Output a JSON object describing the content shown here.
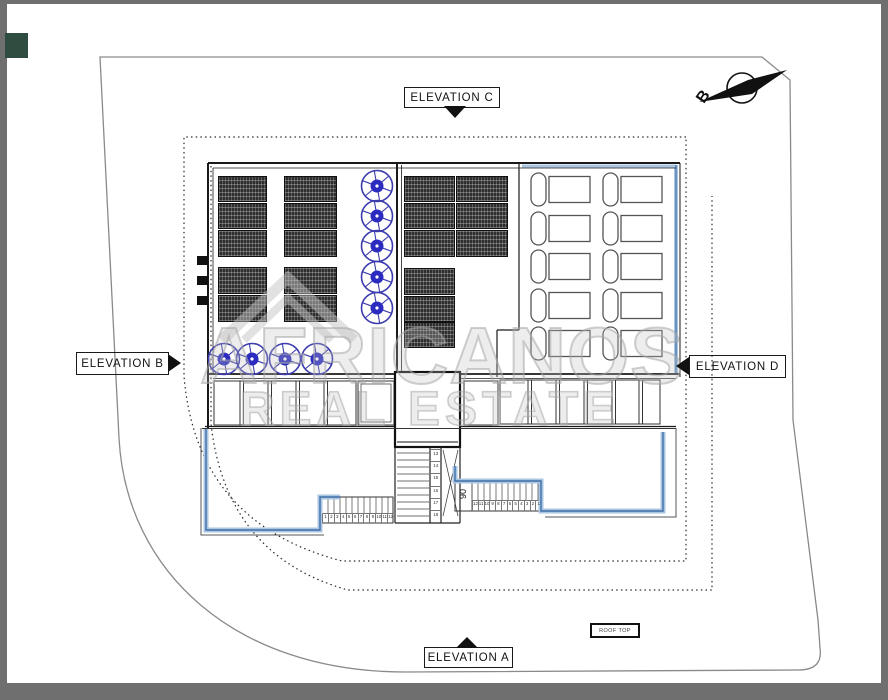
{
  "drawing": {
    "labels": {
      "elevation_a": "ELEVATION A",
      "elevation_b": "ELEVATION B",
      "elevation_c": "ELEVATION C",
      "elevation_d": "ELEVATION D",
      "roof_top": "ROOF TOP",
      "north_arrow_letter": "B",
      "stair_dimension": "90"
    },
    "stairs": {
      "bottom_run_numbers": [
        "1",
        "2",
        "3",
        "4",
        "5",
        "6",
        "7",
        "8",
        "9",
        "10",
        "11",
        "12"
      ],
      "right_run_numbers": [
        "12",
        "11",
        "10",
        "9",
        "8",
        "7",
        "6",
        "5",
        "4",
        "3",
        "2",
        "1"
      ],
      "shaft_run_numbers": [
        "13",
        "14",
        "15",
        "16",
        "17",
        "18"
      ]
    },
    "watermark": {
      "line1": "AFRICANOS",
      "line2": "REAL ESTATE"
    },
    "colors": {
      "page_frame": "#6f6f6f",
      "paper": "#ffffff",
      "fan_blue": "#2b2bc0",
      "terrace_parapet_light": "#aac6e2",
      "terrace_parapet_dark": "#3f6fa8",
      "solar_panel": "#2e2e2e",
      "site_boundary": "#8a8a8a",
      "watermark_gray": "#c6c6c6",
      "corner_swatch": "#2e4c40"
    }
  }
}
